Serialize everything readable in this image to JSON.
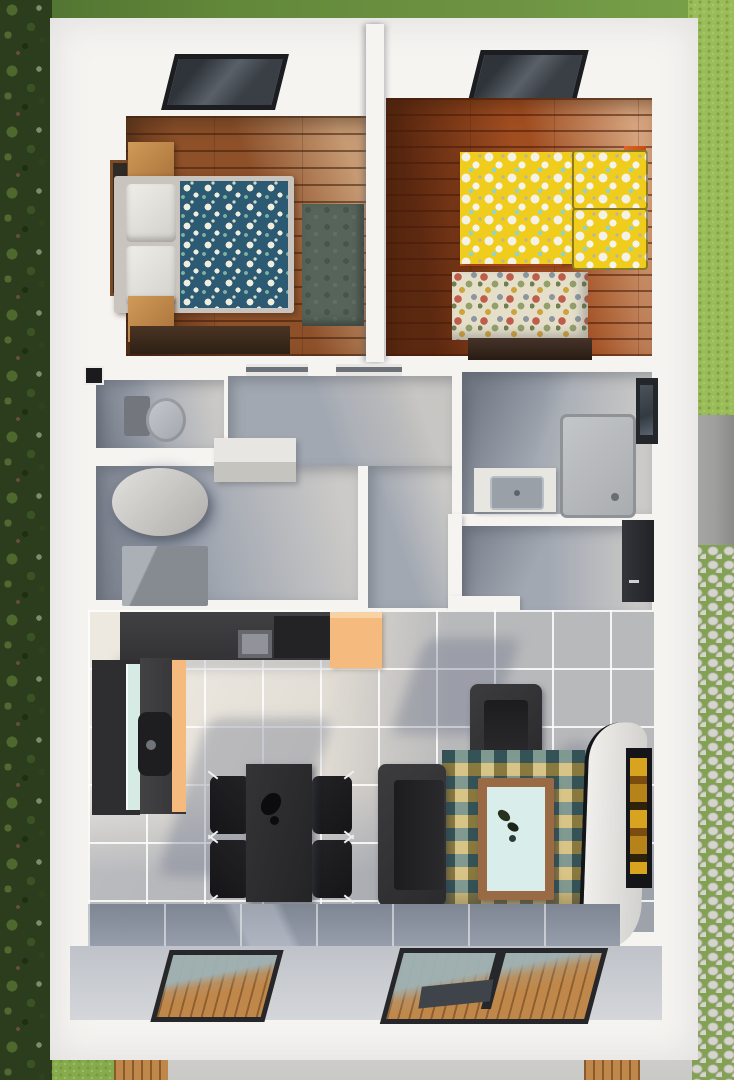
{
  "scene": {
    "type": "3d-floorplan-top-view",
    "rooms": [
      {
        "name": "bedroom-1",
        "floor": "dark-wood-planks",
        "items": [
          "skylight",
          "side-window",
          "nightstand",
          "double-bed-blue-floral-duvet",
          "white-pillows",
          "nightstand",
          "green-rug",
          "wood-dresser"
        ]
      },
      {
        "name": "bedroom-2",
        "floor": "red-wood-planks",
        "items": [
          "skylight",
          "bed-yellow-floral-duvet",
          "yellow-floral-pillows",
          "orange-bed-frame",
          "multicolor-floral-rug",
          "wood-dresser"
        ]
      },
      {
        "name": "wc",
        "floor": "gray-tile",
        "items": [
          "toilet",
          "wall-niche"
        ]
      },
      {
        "name": "laundry-room",
        "floor": "gray-tile",
        "items": [
          "water-tank-cylinder",
          "wall-shelf",
          "washer-unit"
        ]
      },
      {
        "name": "hallway",
        "floor": "gray-tile",
        "items": [
          "door-lintels"
        ]
      },
      {
        "name": "bathroom",
        "floor": "gray-tile",
        "items": [
          "vanity-sink",
          "shower-tray",
          "side-window"
        ]
      },
      {
        "name": "entry",
        "floor": "gray-tile",
        "items": [
          "front-door"
        ]
      },
      {
        "name": "kitchen",
        "items": [
          "l-shaped-counter",
          "stove",
          "sink-with-faucet",
          "teal-glass-front",
          "orange-cabinet"
        ]
      },
      {
        "name": "dining-area",
        "items": [
          "dining-table",
          "black-bottle",
          "four-black-chairs"
        ]
      },
      {
        "name": "living-area",
        "items": [
          "armchair",
          "sofa",
          "triangle-pattern-rug",
          "wood-coffee-table",
          "curved-tv-stand",
          "wall-screen",
          "two-glass-sliding-doors"
        ]
      }
    ],
    "exterior": [
      "hedge-left",
      "lawn-top",
      "lawn-right",
      "fence-wall",
      "cobblestone-path",
      "concrete-patio",
      "wood-deck-strips"
    ],
    "palette": {
      "roof": "#f6f4f1",
      "hedge": "#2c3d1e",
      "grass-top": "#628739",
      "grass-right": "#9abd5a",
      "cobble": "#d6d5cd",
      "cobble-joint": "#82a152",
      "concrete": "#c9c9c6",
      "deck-wood": "#c0874a",
      "fence": "#9e9e9c",
      "tile-gray": "#a2a8b2",
      "tile-cream": "#ddd8d0",
      "wood1": "#8d5029",
      "wood2": "#a04d20",
      "charcoal": "#39393b",
      "near-black": "#1e1e20",
      "orange-cabinet": "#f5ba7d",
      "bed-orange": "#d8581c",
      "duvet-blue": "#2d5a73",
      "duvet-yellow": "#f0cd1c",
      "teal-glass": "#d5ebe4",
      "rug-green": "#57645a",
      "rug2-cream": "#e5dfca",
      "lrug-teal": "#2b5f5e",
      "lrug-cream": "#e8e2cf",
      "lrug-mustard": "#c79f2f",
      "lrug-slate": "#3d4a52",
      "table-wood": "#996a43",
      "table-top": "#d9edeb",
      "stand-white": "#ecebe8",
      "tv-amber": "#d8a31f",
      "fixture-white": "#e8e6e1",
      "fixture-gray": "#b8bcc1",
      "glass-blue": "#9eb2b5",
      "frame-dark": "#26272a"
    }
  }
}
